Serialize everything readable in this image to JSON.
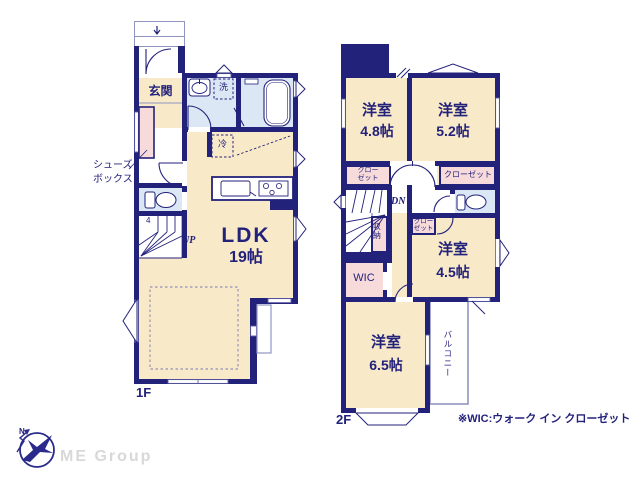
{
  "colors": {
    "wall_navy": "#23227b",
    "room_beige": "#f8e9c9",
    "room_blue": "#dbe7f5",
    "room_pink": "#f7dbdb",
    "text_navy": "#23227b",
    "thin_line": "#8f95c0",
    "logo_gray": "#d8d8d8"
  },
  "floor1": {
    "label": "1F",
    "entrance": "玄関",
    "laundry": "洗",
    "fridge": "冷",
    "shoebox_line1": "シューズ",
    "shoebox_line2": "ボックス",
    "stairs_up": "UP",
    "stairs_step": "4",
    "ldk_name": "LDK",
    "ldk_size": "19帖"
  },
  "floor2": {
    "label": "2F",
    "room_48_name": "洋室",
    "room_48_size": "4.8帖",
    "room_52_name": "洋室",
    "room_52_size": "5.2帖",
    "room_45_name": "洋室",
    "room_45_size": "4.5帖",
    "room_65_name": "洋室",
    "room_65_size": "6.5帖",
    "closet_48_line1": "クロー",
    "closet_48_line2": "ゼット",
    "closet_52": "クローゼット",
    "closet_45_line1": "クロー",
    "closet_45_line2": "ゼット",
    "storage": "収納",
    "wic": "WIC",
    "stairs_down": "DN",
    "balcony": "バルコニー"
  },
  "footer": {
    "note": "※WIC:ウォーク イン クローゼット",
    "company": "ME Group",
    "compass_north": "N"
  }
}
